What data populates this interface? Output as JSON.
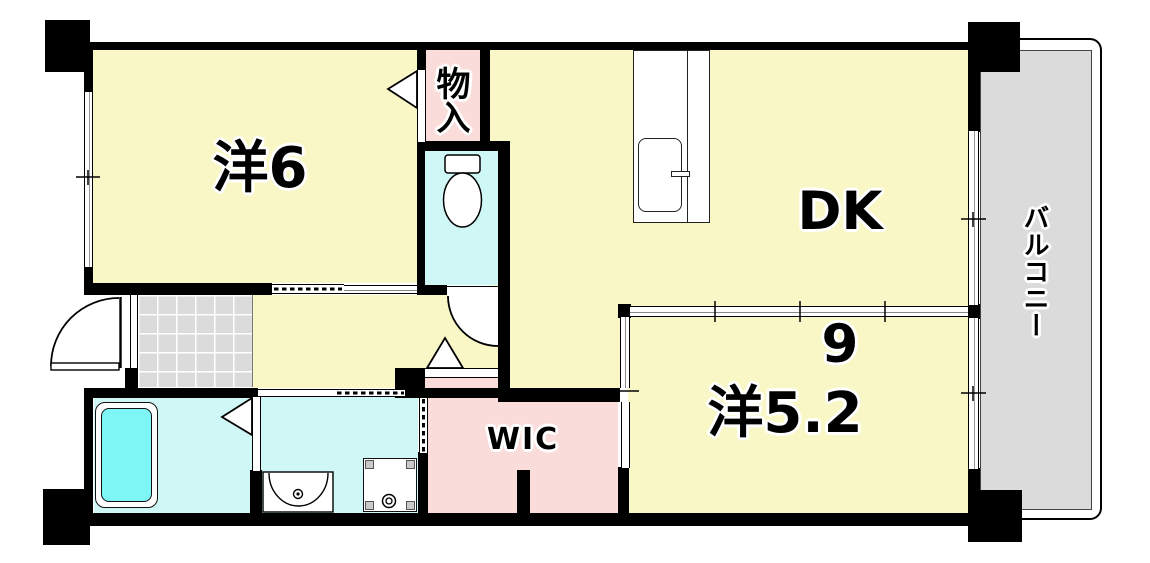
{
  "floorplan": {
    "rooms": {
      "western6": {
        "label": "洋6"
      },
      "dk": {
        "label": "DK",
        "size": "9"
      },
      "western52": {
        "label": "洋5.2"
      },
      "wic": {
        "label": "WIC"
      },
      "storage": {
        "label": "物入"
      },
      "balcony": {
        "label": "バルコニー"
      }
    },
    "colors": {
      "room_yellow": "#FAF7C6",
      "closet_pink": "#FADCDB",
      "wet_cyan": "#CFF7F6",
      "tub_cyan": "#7EF6F6",
      "tile_gray": "#DBDBDB",
      "balcony_gray": "#DBDBDB",
      "wall_black": "#000000"
    }
  }
}
